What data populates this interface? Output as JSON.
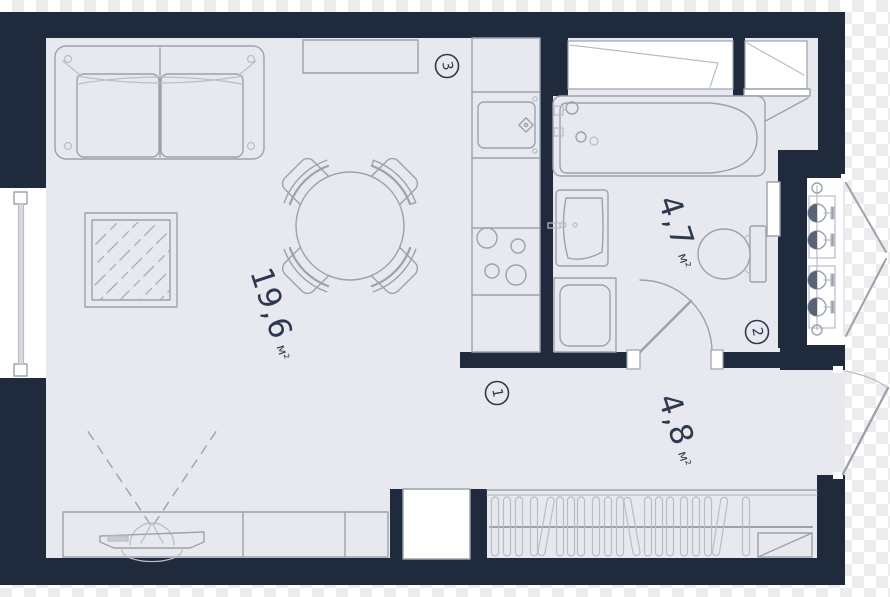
{
  "image": {
    "kind": "apartment floor plan (studio)",
    "colors": {
      "wall": "#1f2b3c",
      "floor": "#e8e9ee",
      "fixture_white": "#ffffff",
      "furniture_line": "#9aa2ae",
      "text": "#2e3950",
      "checker_light": "#ffffff",
      "checker_dark": "#ececec"
    }
  },
  "rooms": [
    {
      "id": "living-room",
      "area": "19,6",
      "unit": "м²"
    },
    {
      "id": "bathroom",
      "area": "4,7",
      "unit": "м²"
    },
    {
      "id": "hallway",
      "area": "4,8",
      "unit": "м²"
    }
  ],
  "markers": [
    {
      "label": "1",
      "location": "hallway"
    },
    {
      "label": "2",
      "location": "bathroom"
    },
    {
      "label": "3",
      "location": "kitchen"
    }
  ],
  "symbols": [
    "sofa",
    "dining-table",
    "chair",
    "rug",
    "tv-stand",
    "tv-viewing-angle",
    "wall-shelf",
    "kitchen-counter",
    "kitchen-sink",
    "stove",
    "window",
    "bathtub",
    "washbasin",
    "washing-machine",
    "toilet",
    "door-swing",
    "wardrobe-hangers",
    "wardrobe-shelf",
    "radiator-risers",
    "entry-door",
    "service-hatch-doors",
    "duct-shaft"
  ]
}
